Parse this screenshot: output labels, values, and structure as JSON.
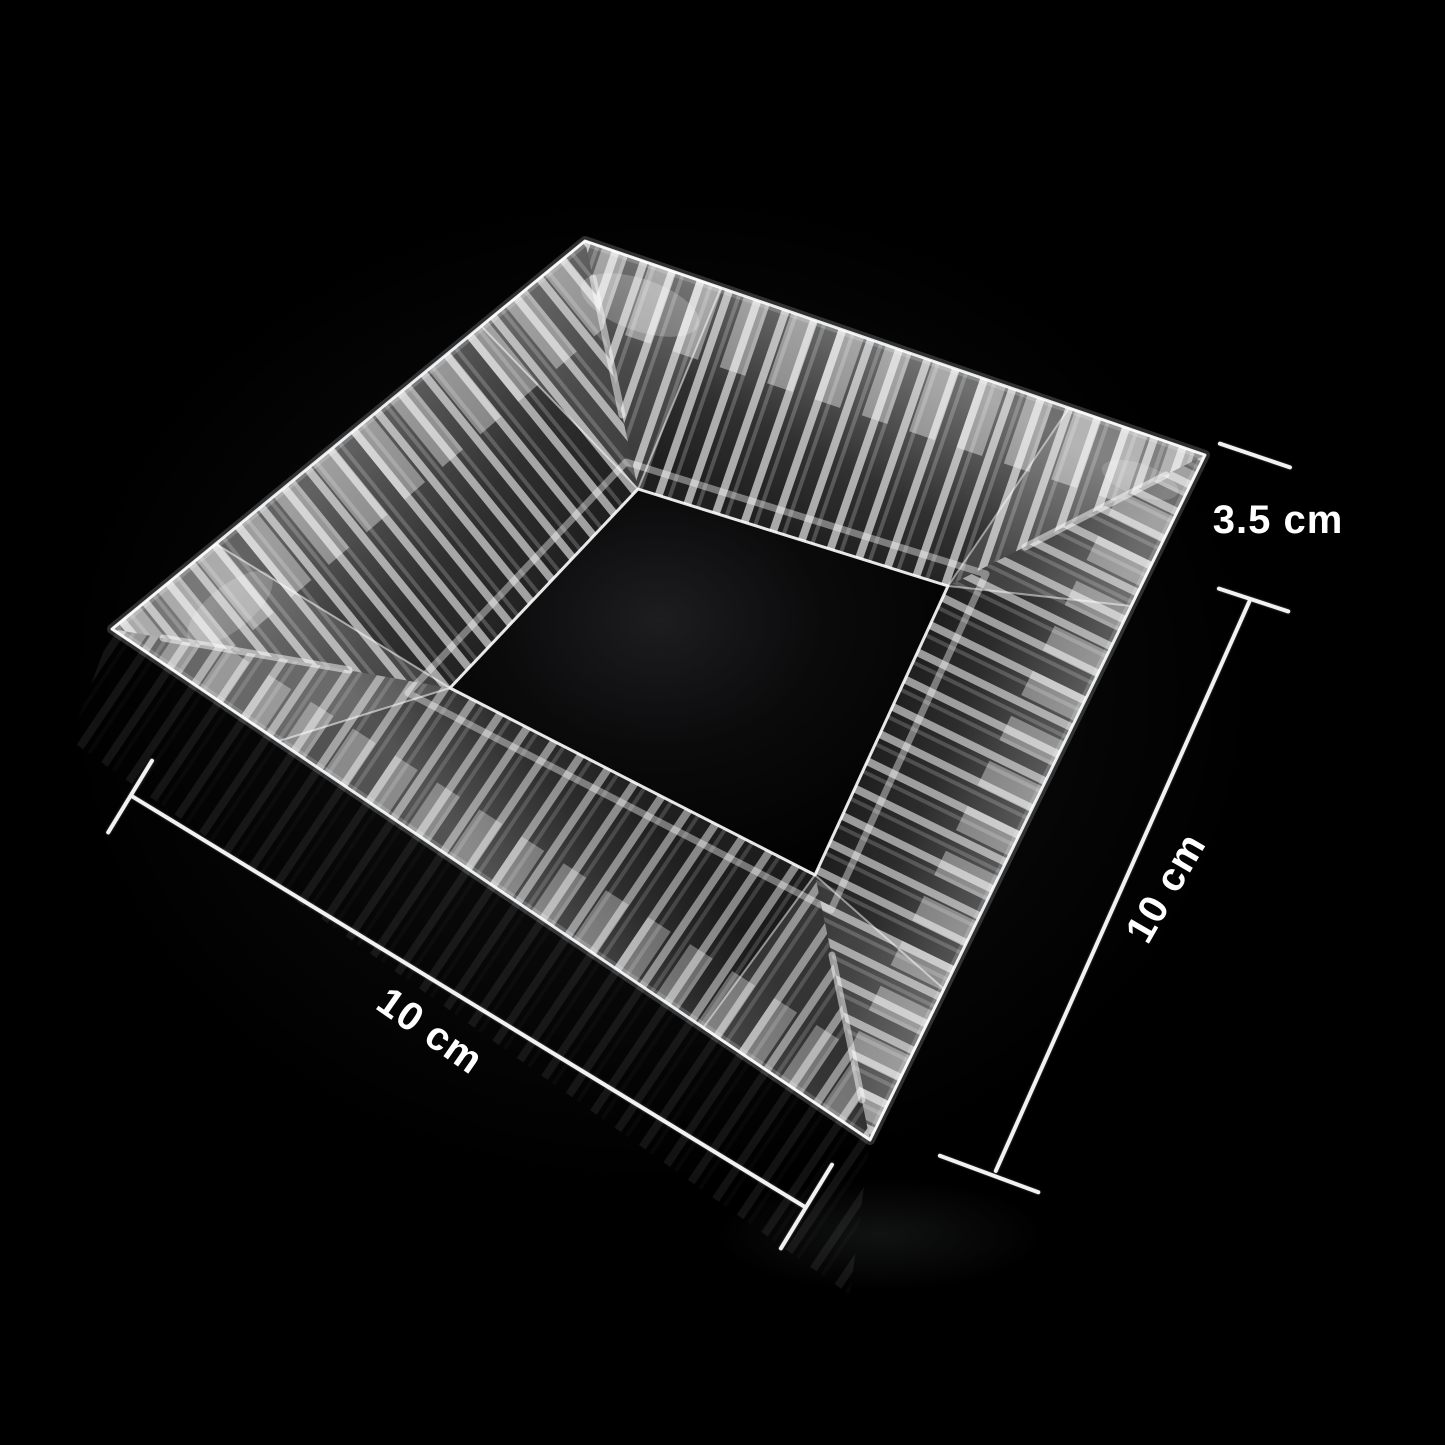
{
  "image": {
    "subject": "clear-glass-square-ashtray",
    "background_color": "#000000"
  },
  "annotations": {
    "line_color": "#f2f2f2",
    "text_color": "#ffffff",
    "height_label": "3.5 cm",
    "right_width_label": "10 cm",
    "bottom_width_label": "10 cm"
  }
}
